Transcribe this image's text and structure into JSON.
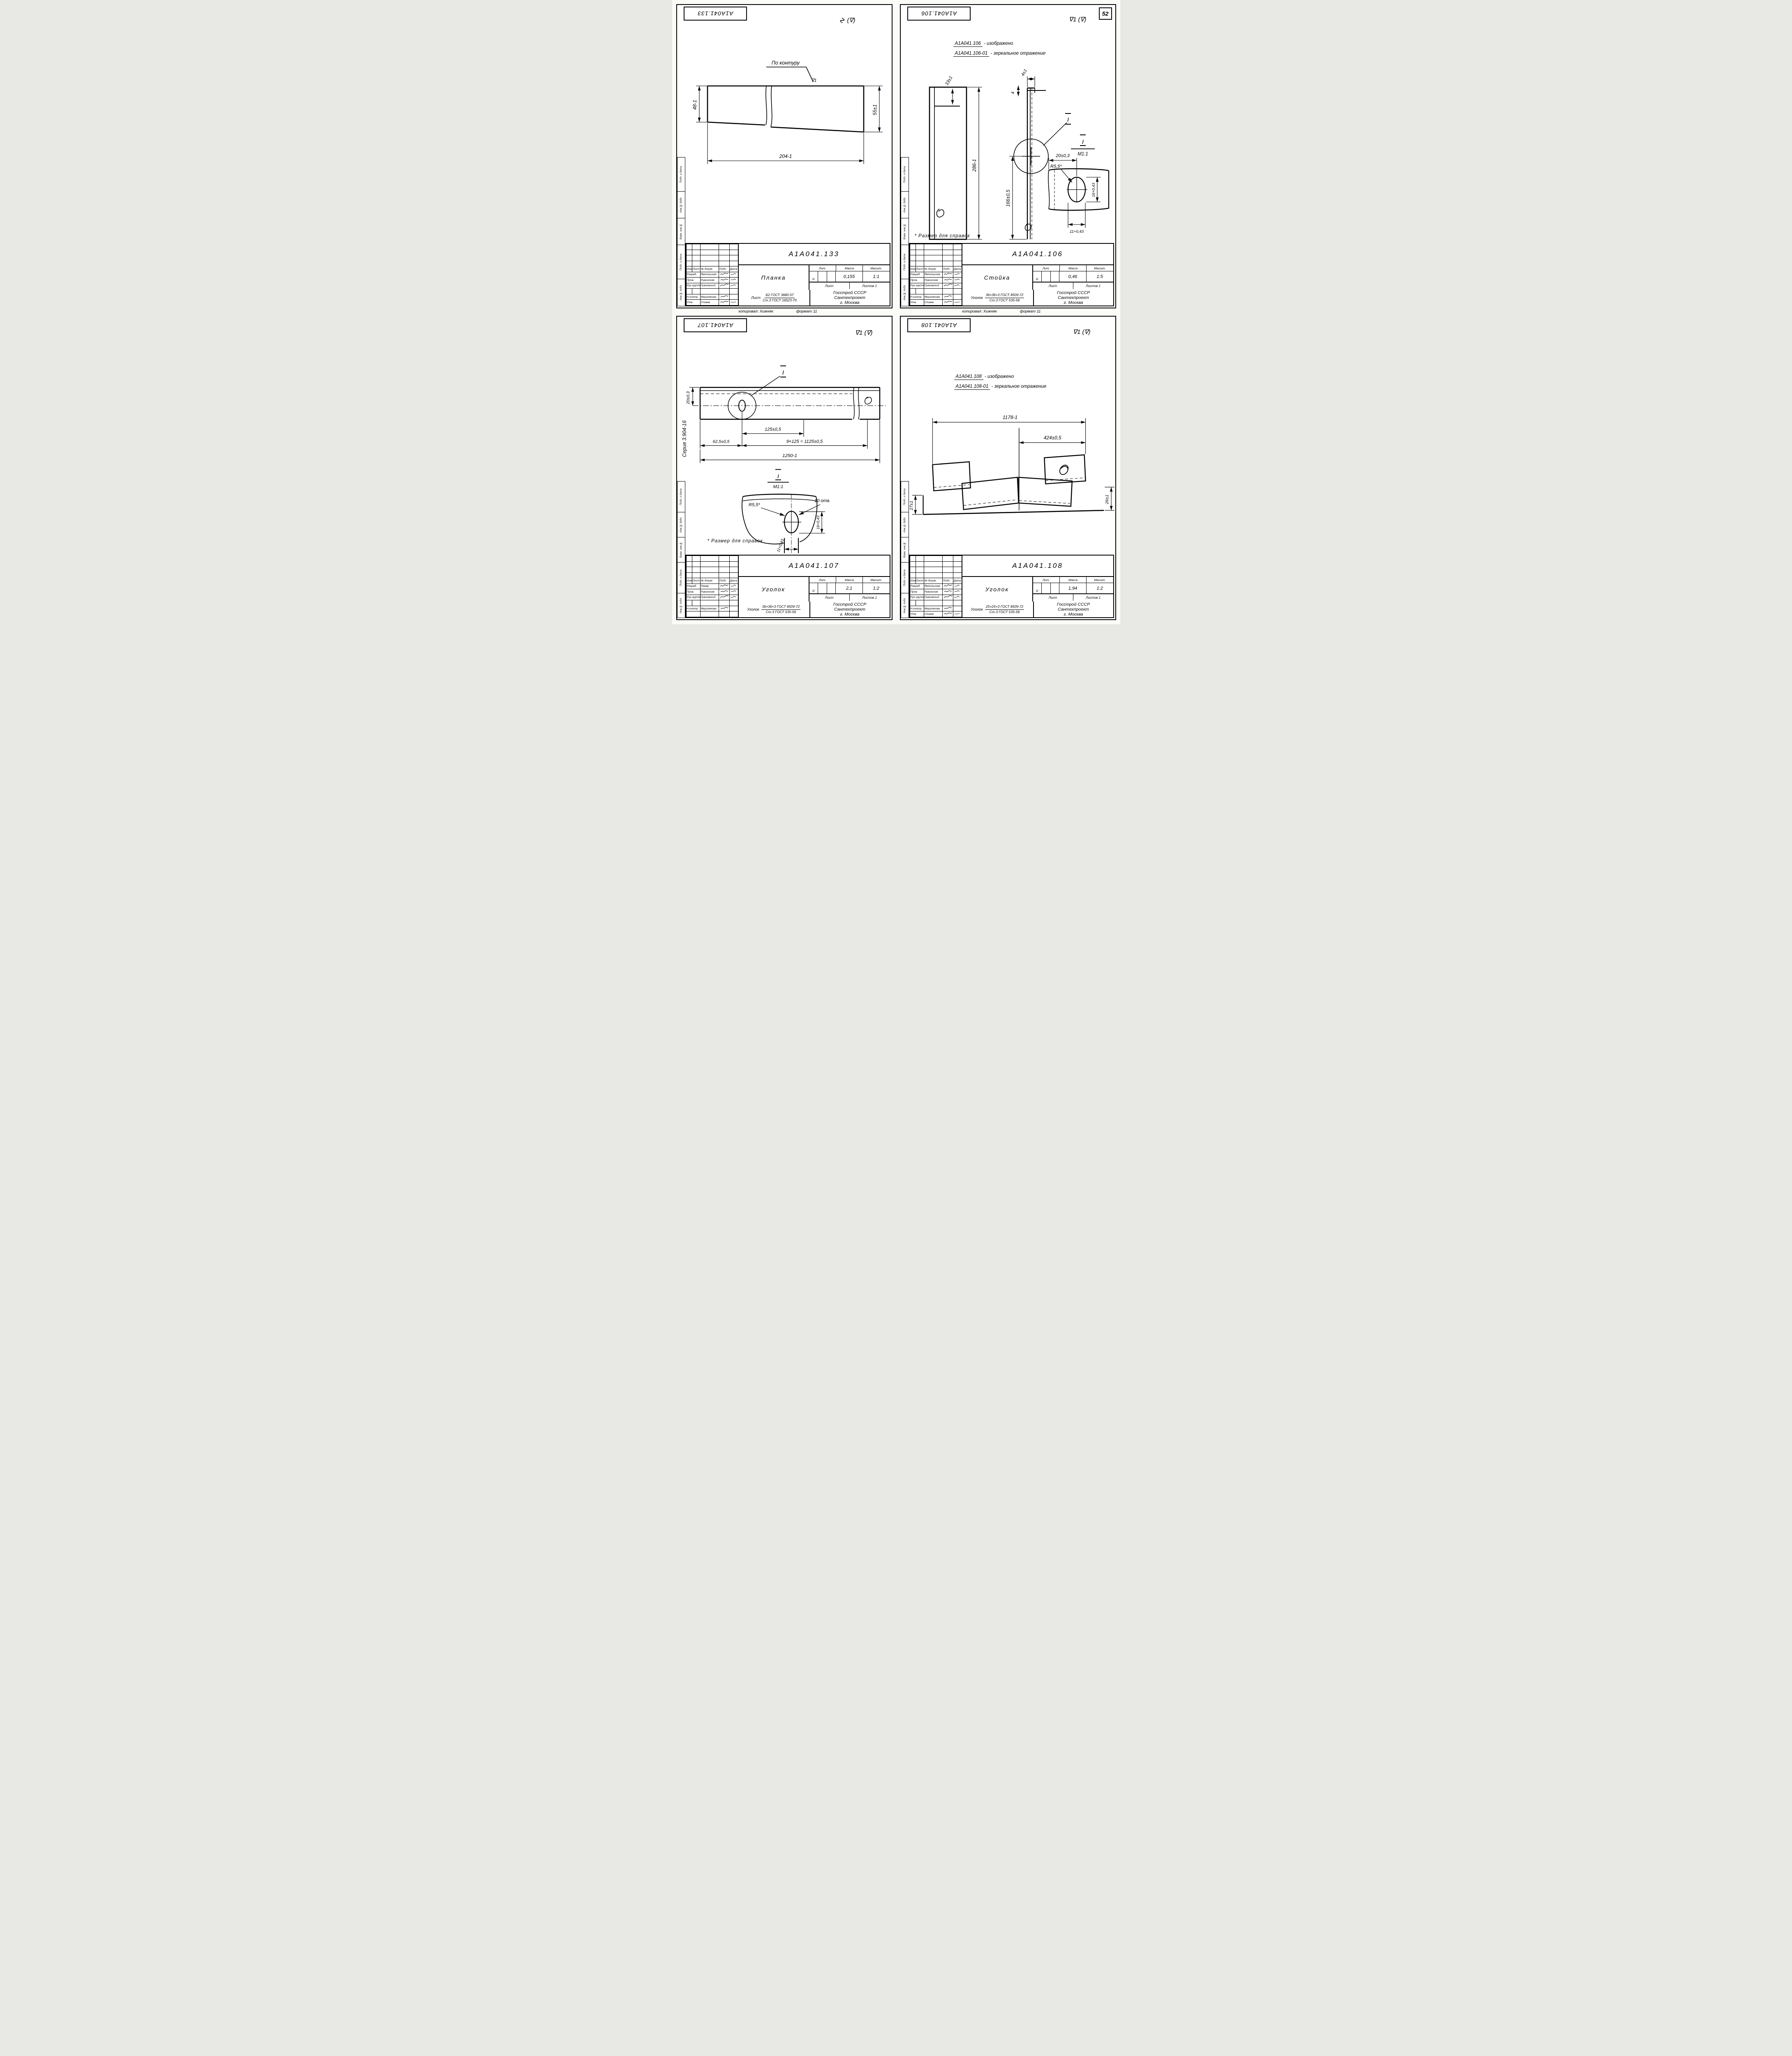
{
  "page": {
    "number": "52"
  },
  "common": {
    "org_line1": "Госстрой СССР",
    "org_line2": "Сантехпроект",
    "org_line3": "г. Москва",
    "copied": "копировал: Хижняк",
    "format": "формат 11",
    "note": "* Размер для справок",
    "lit": "и",
    "labels": {
      "izm": "Изм.",
      "list": "Лист",
      "ndok": "№ докум.",
      "podp": "Подп.",
      "data": "Дата",
      "razrab": "Разраб.",
      "prov": "Пров.",
      "ruk": "Рук.группы",
      "nkontr": "Н.контр.",
      "lit": "Лит.",
      "massa": "Масса",
      "masshtab": "Масшт.",
      "list2": "Лист",
      "listov": "Листов",
      "listov_val": "1"
    },
    "names": {
      "prov": "Рувинская",
      "ruk": "Грановский",
      "nkontr": "Мерзлякова"
    },
    "strip": [
      "Подп. и дата",
      "Инв.№ дубл.",
      "Взам. инв.№",
      "Подп. и дата",
      "Инв.№ подл."
    ]
  },
  "sheets": [
    {
      "stamp": "А1А041.133",
      "doc": "А1А041.133",
      "title": "Планка",
      "mass": "0,155",
      "scale": "1:1",
      "razrab": "Ямпольская",
      "utv_label": "Утв.",
      "utv": "Спивак",
      "mat_prefix": "Лист",
      "mat_top": "Б2 ГОСТ 3680-57",
      "mat_bot": "Ст.3 ГОСТ 16523-70",
      "rough_pre": "∿",
      "rough": "(∇)",
      "dims": {
        "contour": "По контуру",
        "mark": "∇1",
        "h_left": "48-1",
        "h_right": "55±1",
        "len": "204-1"
      }
    },
    {
      "stamp": "А1А041.106",
      "doc": "А1А041.106",
      "title": "Стойка",
      "mass": "0,46",
      "scale": "1:5",
      "razrab": "Ямпольская",
      "utv_label": "Утв.",
      "utv": "Спивак",
      "mat_prefix": "Уголок",
      "mat_top": "36×36×3 ГОСТ 8509-72",
      "mat_bot": "Ст.3 ГОСТ 535-58",
      "rough": "∇1 (∇)",
      "header": {
        "doc1": "А1А041.106",
        "txt1": "- изображено",
        "doc2": "А1А041.106-01",
        "txt2": "- зеркальное отражение"
      },
      "dims": {
        "d33": "33±1",
        "d286": "286-1",
        "d4a": "4±1",
        "d4b": "4",
        "d166": "166±0,5",
        "detail": "I",
        "mscale": "М1:1",
        "d20": "20±0,3",
        "r": "R5,5*",
        "d16": "16+0,43",
        "d11": "11+0,43"
      }
    },
    {
      "stamp": "А1А041.107",
      "doc": "А1А041.107",
      "title": "Уголок",
      "mass": "2,1",
      "scale": "1:2",
      "razrab": "Раева",
      "utv_label": "",
      "utv": "",
      "mat_prefix": "Уголок",
      "mat_top": "36×36×3 ГОСТ 8509-72",
      "mat_bot": "Ст.3 ГОСТ 535-56",
      "rough": "∇1 (∇)",
      "series": "Серия 3.904-16",
      "dims": {
        "d20": "20±0,3",
        "d125": "125±0,5",
        "d62": "62,5±0,5",
        "d1125": "9×125 = 1125±0,5",
        "d1250": "1250-1",
        "detail": "I",
        "mscale": "М1:1",
        "holes": "10 отв.",
        "r": "R5,5*",
        "d16": "16+0,43",
        "d11": "11+0,43"
      }
    },
    {
      "stamp": "А1А041.108",
      "doc": "А1А041.108",
      "title": "Уголок",
      "mass": "1,94",
      "scale": "1:2",
      "razrab": "Ямпольская",
      "utv_label": "Утв.",
      "utv": "Спивак",
      "mat_prefix": "Уголок",
      "mat_top": "25×25×3 ГОСТ 8509-72",
      "mat_bot": "Ст.3 ГОСТ 535-58",
      "rough": "∇1 (∇)",
      "header": {
        "doc1": "А1А041.108",
        "txt1": "- изображено",
        "doc2": "А1А041.108-01",
        "txt2": "- зеркальное отражение"
      },
      "dims": {
        "d1178": "1178-1",
        "d424": "424±0,5",
        "d27": "27±1",
        "d26": "26±1"
      }
    }
  ]
}
